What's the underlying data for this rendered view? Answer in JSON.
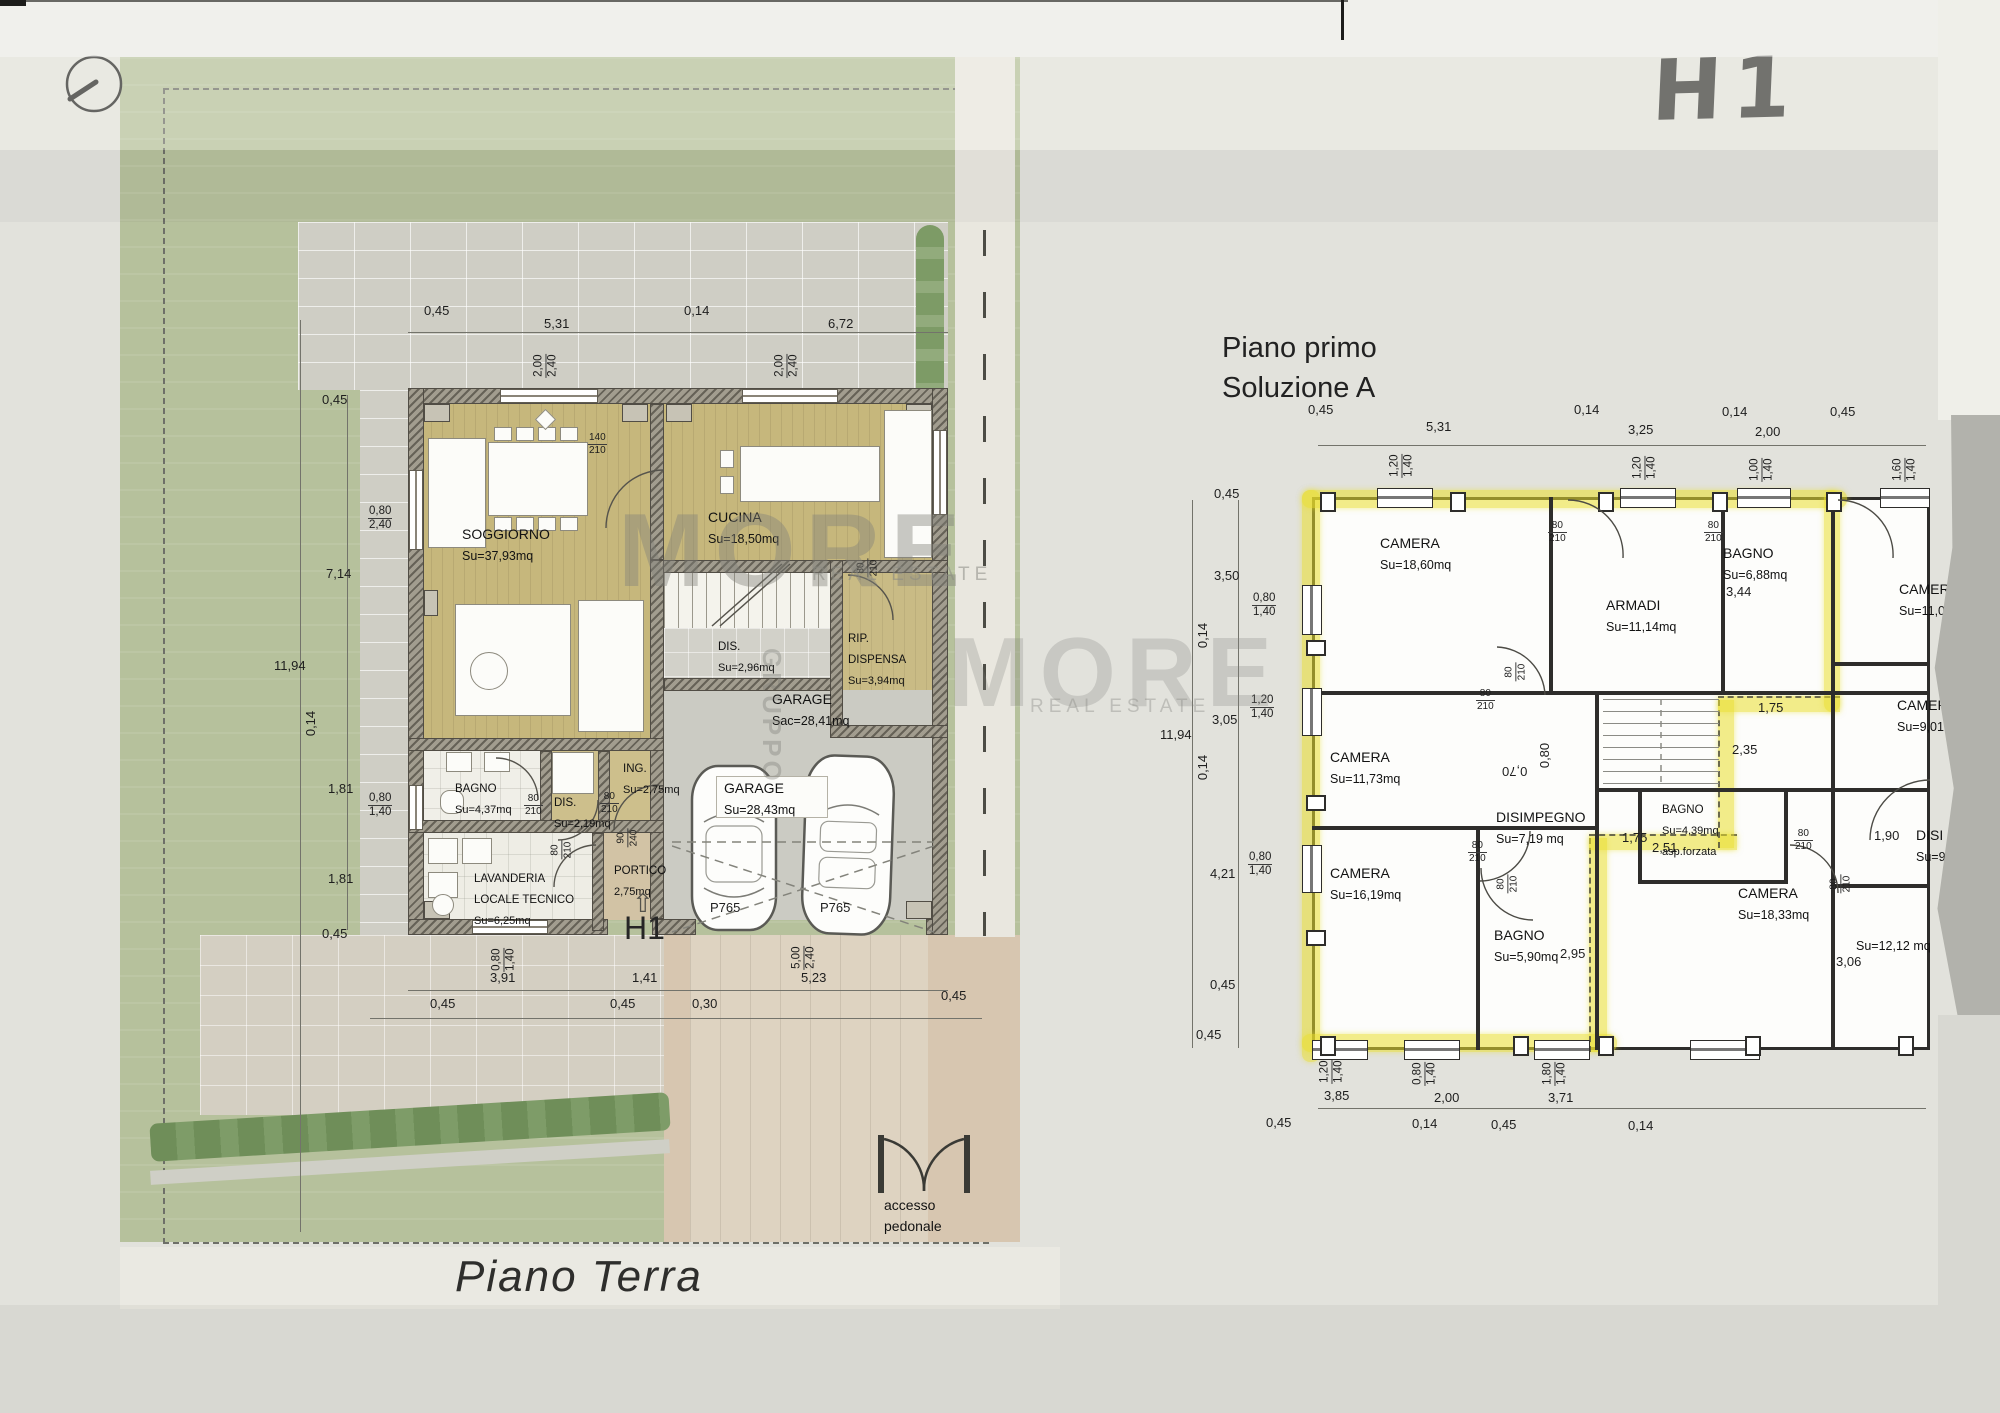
{
  "scan": {
    "handwritten_code": "H1"
  },
  "watermark": {
    "brand": "MORE",
    "tagline": "REAL ESTATE",
    "vertical": "GRUPPO"
  },
  "icons": {
    "north_indicator": "circle-with-bearing-line",
    "entry_arrow": "⇧"
  },
  "ground": {
    "title": "Piano Terra",
    "unit_code": "H1",
    "access": {
      "line1": "accesso",
      "line2": "pedonale"
    },
    "parking": {
      "p1": "P765",
      "p2": "P765"
    },
    "rooms": {
      "soggiorno": {
        "name": "SOGGIORNO",
        "area": "Su=37,93mq"
      },
      "cucina": {
        "name": "CUCINA",
        "area": "Su=18,50mq"
      },
      "dis_stairs": {
        "name": "DIS.",
        "area": "Su=2,96mq"
      },
      "rip_dispensa": {
        "line1": "RIP.",
        "line2": "DISPENSA",
        "area": "Su=3,94mq"
      },
      "garage": {
        "name": "GARAGE",
        "area_gross": "Sac=28,41mq",
        "area_net": "Su=28,43mq"
      },
      "bagno": {
        "name": "BAGNO",
        "area": "Su=4,37mq"
      },
      "dis": {
        "name": "DIS.",
        "area": "Su=2,19mq"
      },
      "ingresso": {
        "name": "ING.",
        "area": "Su=2,75mq"
      },
      "lavanderia": {
        "line1": "LAVANDERIA",
        "line2": "LOCALE TECNICO",
        "area": "Su=6,25mq"
      },
      "portico": {
        "name": "PORTICO",
        "area": "2,75mq"
      }
    },
    "dims": {
      "top": [
        "0,45",
        "5,31",
        "0,14",
        "6,72"
      ],
      "left": [
        "0,45",
        "7,14",
        "11,94",
        "0,14",
        "1,81",
        "1,81",
        "0,45"
      ],
      "bottom": [
        "3,91",
        "1,41",
        "5,23",
        "0,45",
        "0,45",
        "0,30",
        "0,45"
      ],
      "win_top1": {
        "a": "2,00",
        "b": "2,40"
      },
      "win_top2": {
        "a": "2,00",
        "b": "2,40"
      },
      "win_left1": {
        "a": "0,80",
        "b": "2,40"
      },
      "win_left2": {
        "a": "0,80",
        "b": "1,40"
      },
      "win_bottom1": {
        "a": "0,80",
        "b": "1,40"
      },
      "win_garage": {
        "a": "5,00",
        "b": "2,40"
      },
      "door_kitchen": {
        "a": "140",
        "b": "210"
      },
      "door_std": {
        "a": "80",
        "b": "210"
      },
      "door_portico": {
        "a": "90",
        "b": "240"
      }
    }
  },
  "first": {
    "title_line1": "Piano primo",
    "title_line2": "Soluzione A",
    "rooms": {
      "camera1": {
        "name": "CAMERA",
        "area": "Su=18,60mq"
      },
      "armadi": {
        "name": "ARMADI",
        "area": "Su=11,14mq"
      },
      "bagno1": {
        "name": "BAGNO",
        "area": "Su=6,88mq"
      },
      "camera2": {
        "name": "CAMERA",
        "area": "Su=11,73mq"
      },
      "camera3": {
        "name": "CAMERA",
        "area": "Su=16,19mq"
      },
      "disimpegno": {
        "name": "DISIMPEGNO",
        "area": "Su=7,19 mq"
      },
      "bagno2": {
        "name": "BAGNO",
        "area": "Su=5,90mq"
      },
      "bagno3": {
        "name": "BAGNO",
        "area": "Su=4,39mq",
        "note": "asp.forzata"
      },
      "camera4": {
        "name": "CAMERA",
        "area": "Su=18,33mq"
      },
      "camera5": {
        "name": "CAMER",
        "area": "Su=11,0"
      },
      "camera6": {
        "name": "CAMER",
        "area": "Su=9,01"
      },
      "disimpegno2": {
        "name": "DISI",
        "area": "Su=9"
      },
      "room12": {
        "area": "Su=12,12 mq"
      }
    },
    "dims": {
      "top": [
        "0,45",
        "5,31",
        "0,14",
        "3,25",
        "0,14",
        "2,00",
        "0,45"
      ],
      "left": [
        "0,45",
        "3,50",
        "0,14",
        "3,05",
        "11,94",
        "0,14",
        "4,21",
        "0,45"
      ],
      "bottom": [
        "0,45",
        "3,85",
        "2,00",
        "3,71",
        "3,96",
        "0,45",
        "0,14",
        "0,45",
        "0,14"
      ],
      "inner": [
        "3,44",
        "1,75",
        "2,35",
        "2,51",
        "1,75",
        "2,95",
        "1,90",
        "3,06",
        "0,80",
        "0,70"
      ],
      "win_top": [
        {
          "a": "1,20",
          "b": "1,40"
        },
        {
          "a": "1,20",
          "b": "1,40"
        },
        {
          "a": "1,00",
          "b": "1,40"
        },
        {
          "a": "1,60",
          "b": "1,40"
        }
      ],
      "win_left": [
        {
          "a": "0,80",
          "b": "1,40"
        },
        {
          "a": "1,20",
          "b": "1,40"
        },
        {
          "a": "0,80",
          "b": "1,40"
        }
      ],
      "win_bottom": [
        {
          "a": "1,20",
          "b": "1,40"
        },
        {
          "a": "0,80",
          "b": "1,40"
        },
        {
          "a": "1,80",
          "b": "1,40"
        },
        {
          "a": "1,60",
          "b": "1,40"
        }
      ],
      "door_std": {
        "a": "80",
        "b": "210"
      }
    }
  }
}
